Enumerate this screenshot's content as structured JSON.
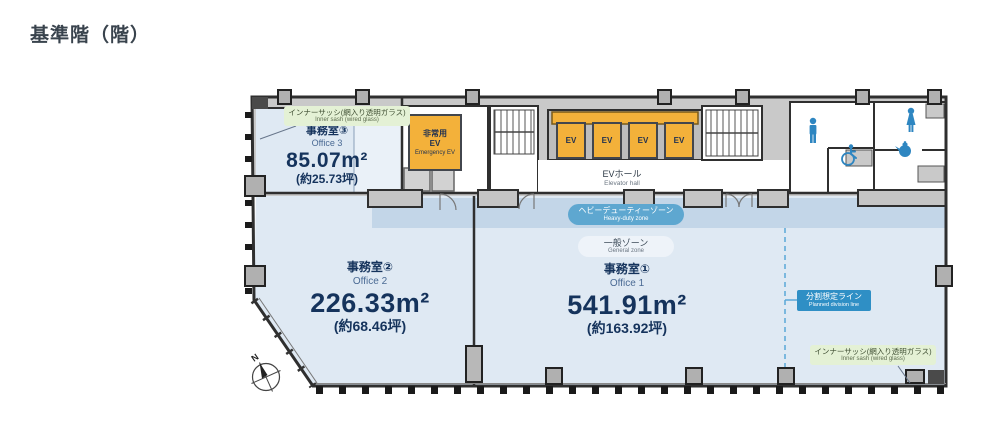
{
  "page": {
    "title": "基準階（階）"
  },
  "plan": {
    "offices": {
      "office3": {
        "name_jp": "事務室③",
        "name_en": "Office 3",
        "area": "85.07m²",
        "tsubo": "(約25.73坪)"
      },
      "office2": {
        "name_jp": "事務室②",
        "name_en": "Office 2",
        "area": "226.33m²",
        "tsubo": "(約68.46坪)"
      },
      "office1": {
        "name_jp": "事務室①",
        "name_en": "Office 1",
        "area": "541.91m²",
        "tsubo": "(約163.92坪)"
      }
    },
    "ev_hall": {
      "label_jp": "EVホール",
      "label_en": "Elevator hall"
    },
    "emergency_ev": {
      "line1": "非常用",
      "line2": "EV",
      "label_en": "Emergency EV"
    },
    "elevators": {
      "labels": [
        "EV",
        "EV",
        "EV",
        "EV"
      ]
    },
    "zones": {
      "heavy_duty": {
        "label_jp": "ヘビーデューティーゾーン",
        "label_en": "Heavy-duty zone"
      },
      "general": {
        "label_jp": "一般ゾーン",
        "label_en": "General zone"
      }
    },
    "division_line": {
      "label_jp": "分割想定ライン",
      "label_en": "Planned division line"
    },
    "inner_sash_top": {
      "label_jp": "インナーサッシ(網入り透明ガラス)",
      "label_en": "Inner sash (wired glass)"
    },
    "inner_sash_bottom": {
      "label_jp": "インナーサッシ(網入り透明ガラス)",
      "label_en": "Inner sash (wired glass)"
    },
    "compass": {
      "label": "N"
    },
    "icons": {
      "mens_restroom": "man-silhouette",
      "womens_restroom": "woman-silhouette",
      "accessible_restroom": "wheelchair-symbol",
      "kitchenette": "teapot-symbol",
      "compass": "compass-rose"
    },
    "colors": {
      "office_fill": "#dfe9f3",
      "heavy_duty_band": "#c3d6e8",
      "elevator_orange": "#f3b13a",
      "zone_badge_blue": "#5ea7d0",
      "division_badge_blue": "#2f8fc5",
      "inner_sash_green": "#e4f1d5",
      "restroom_icon_blue": "#2e86c1",
      "wall": "#2f2f2f",
      "text_navy": "#15335c"
    }
  }
}
